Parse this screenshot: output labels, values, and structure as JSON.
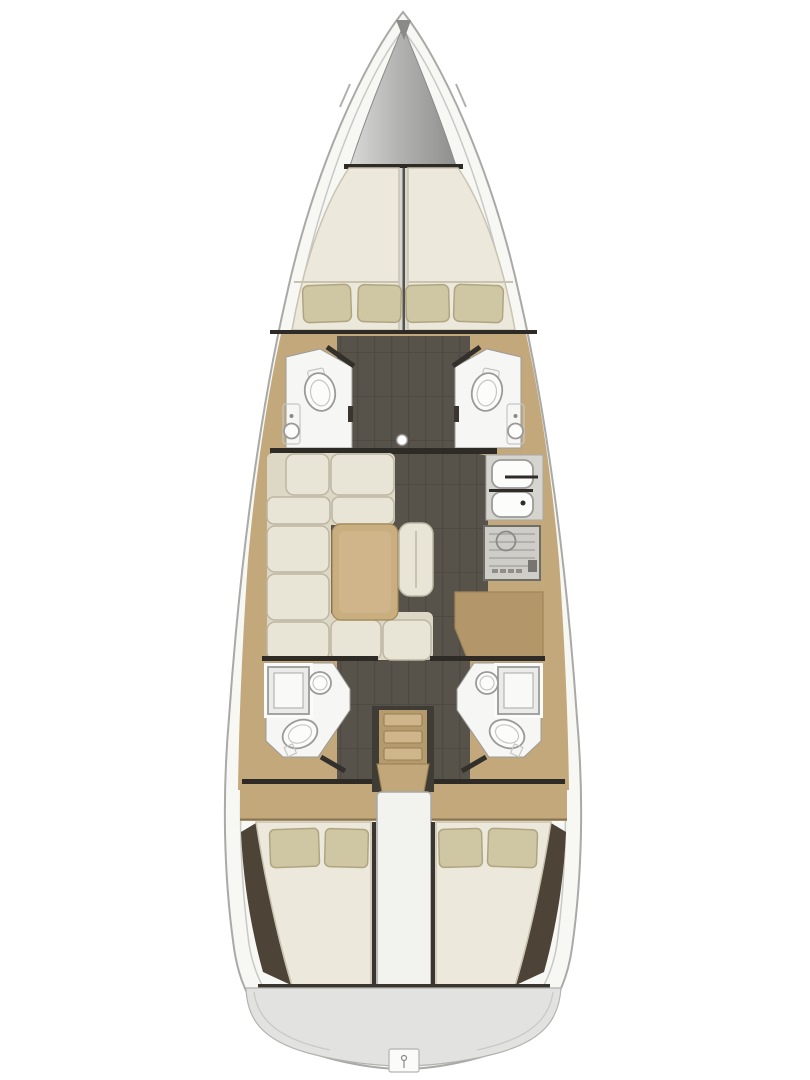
{
  "diagram": {
    "type": "floorplan",
    "subject": "sailing-yacht-interior-top-view",
    "orientation": "bow-up"
  },
  "colors": {
    "background": "#ffffff",
    "hull_fill": "#f7f7f4",
    "anchor_light": "#d9d9d7",
    "anchor_mid": "#b3b3b1",
    "anchor_dark": "#8f8f8d",
    "bow_fitting": "#8a8a88",
    "bulkhead": "#2e2b26",
    "wood": "#c3a87c",
    "wood_dark": "#b3976b",
    "wood_light": "#cfb68a",
    "stair_wood": "#b59a6f",
    "stair_landing": "#c2a77b",
    "stair_well": "#3f3b35",
    "floor": "#57524a",
    "floor_line": "#46423b",
    "mattress": "#ece9dc",
    "berth_gap": "#d8d6d0",
    "berth_gap_line": "#55524c",
    "pillow": "#cfc6a4",
    "cushion": "#e9e5d6",
    "cushion_base": "#ddd8c6",
    "table": "#c9ae80",
    "table_inner": "#d4bb8f",
    "room_white": "#f6f6f4",
    "fixture": "#fcfcfb",
    "fixture_tank": "#e8e8e6",
    "steel": "#d6d4cf",
    "stove": "#cfcdc8",
    "stove_knob": "#8f8d89",
    "stove_dark": "#77756f",
    "shower_glass": "#ebebe9",
    "shower_inner": "#f9f9f7",
    "wedge": "#4d4336",
    "engine_box": "#f2f2ef",
    "transom": "#e2e2e0",
    "ladder_tab": "#fbfbfa",
    "gap_dark": "#3a362f",
    "mast_dot": "#ffffff"
  },
  "inventory": {
    "forward_cabin": {
      "double_berth": 1,
      "pillows": 4
    },
    "forward_heads": {
      "count": 2,
      "toilets": 2,
      "sinks": 2
    },
    "salon": {
      "sofa_cushions": 9,
      "table": 1,
      "ottoman": 1
    },
    "galley": {
      "sink_basins": 2,
      "stove": 1
    },
    "mast_step": 1,
    "aft_heads": {
      "count": 2,
      "showers": 2,
      "toilets": 2,
      "sinks": 2
    },
    "companionway": {
      "steps": 4
    },
    "aft_cabins": {
      "count": 2,
      "double_berths": 2,
      "pillows_each": 2
    },
    "engine_compartment": 1,
    "swim_platform": {
      "ladder_hatch": 1
    }
  }
}
